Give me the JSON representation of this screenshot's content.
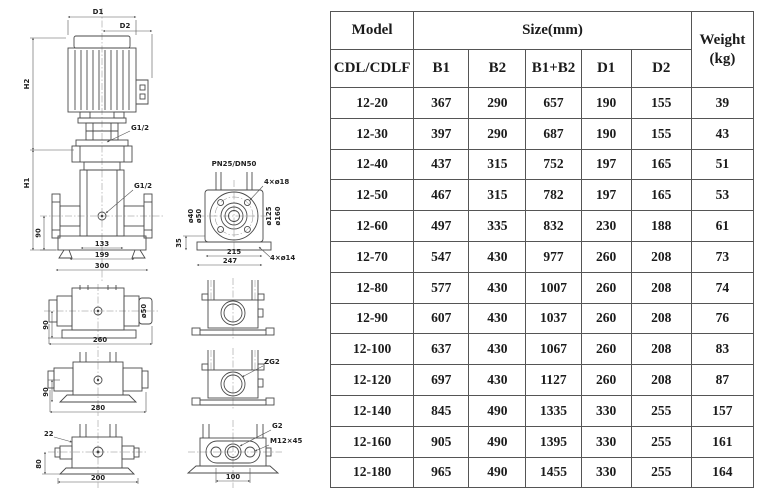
{
  "drawings": {
    "front_view": {
      "dim_d1": "D1",
      "dim_d2": "D2",
      "dim_h2": "H2",
      "dim_h1": "H1",
      "port_upper": "G1/2",
      "port_lower": "G1/2",
      "dim_90": "90",
      "dim_133": "133",
      "dim_199": "199",
      "dim_300": "300"
    },
    "flange_top_view": {
      "title": "PN25/DN50",
      "bolts_top": "4×ø18",
      "dia_40": "ø40",
      "dia_50": "ø50",
      "dia_125": "ø125",
      "dia_160": "ø160",
      "dim_35": "35",
      "dim_215": "215",
      "dim_247": "247",
      "bolts_bottom": "4×ø14"
    },
    "side_view_a": {
      "dim_90": "90",
      "dim_260": "260",
      "dia_50": "ø50"
    },
    "side_view_b": {
      "dim_90": "90",
      "dim_280": "280"
    },
    "side_view_c": {
      "dim_22": "22",
      "dim_80": "80",
      "dim_200": "200"
    },
    "section_view_b": {
      "port": "ZG2"
    },
    "outlet_flange_view": {
      "port": "G2",
      "bolt": "M12×45",
      "dim_100": "100"
    }
  },
  "table": {
    "header": {
      "model": "Model",
      "model_series": "CDL/CDLF",
      "size_group": "Size(mm)",
      "col_b1": "B1",
      "col_b2": "B2",
      "col_b1b2": "B1+B2",
      "col_d1": "D1",
      "col_d2": "D2",
      "weight_top": "Weight",
      "weight_bottom": "(kg)"
    },
    "rows": [
      {
        "model": "12-20",
        "b1": "367",
        "b2": "290",
        "b1b2": "657",
        "d1": "190",
        "d2": "155",
        "weight": "39"
      },
      {
        "model": "12-30",
        "b1": "397",
        "b2": "290",
        "b1b2": "687",
        "d1": "190",
        "d2": "155",
        "weight": "43"
      },
      {
        "model": "12-40",
        "b1": "437",
        "b2": "315",
        "b1b2": "752",
        "d1": "197",
        "d2": "165",
        "weight": "51"
      },
      {
        "model": "12-50",
        "b1": "467",
        "b2": "315",
        "b1b2": "782",
        "d1": "197",
        "d2": "165",
        "weight": "53"
      },
      {
        "model": "12-60",
        "b1": "497",
        "b2": "335",
        "b1b2": "832",
        "d1": "230",
        "d2": "188",
        "weight": "61"
      },
      {
        "model": "12-70",
        "b1": "547",
        "b2": "430",
        "b1b2": "977",
        "d1": "260",
        "d2": "208",
        "weight": "73"
      },
      {
        "model": "12-80",
        "b1": "577",
        "b2": "430",
        "b1b2": "1007",
        "d1": "260",
        "d2": "208",
        "weight": "74"
      },
      {
        "model": "12-90",
        "b1": "607",
        "b2": "430",
        "b1b2": "1037",
        "d1": "260",
        "d2": "208",
        "weight": "76"
      },
      {
        "model": "12-100",
        "b1": "637",
        "b2": "430",
        "b1b2": "1067",
        "d1": "260",
        "d2": "208",
        "weight": "83"
      },
      {
        "model": "12-120",
        "b1": "697",
        "b2": "430",
        "b1b2": "1127",
        "d1": "260",
        "d2": "208",
        "weight": "87"
      },
      {
        "model": "12-140",
        "b1": "845",
        "b2": "490",
        "b1b2": "1335",
        "d1": "330",
        "d2": "255",
        "weight": "157"
      },
      {
        "model": "12-160",
        "b1": "905",
        "b2": "490",
        "b1b2": "1395",
        "d1": "330",
        "d2": "255",
        "weight": "161"
      },
      {
        "model": "12-180",
        "b1": "965",
        "b2": "490",
        "b1b2": "1455",
        "d1": "330",
        "d2": "255",
        "weight": "164"
      }
    ]
  }
}
